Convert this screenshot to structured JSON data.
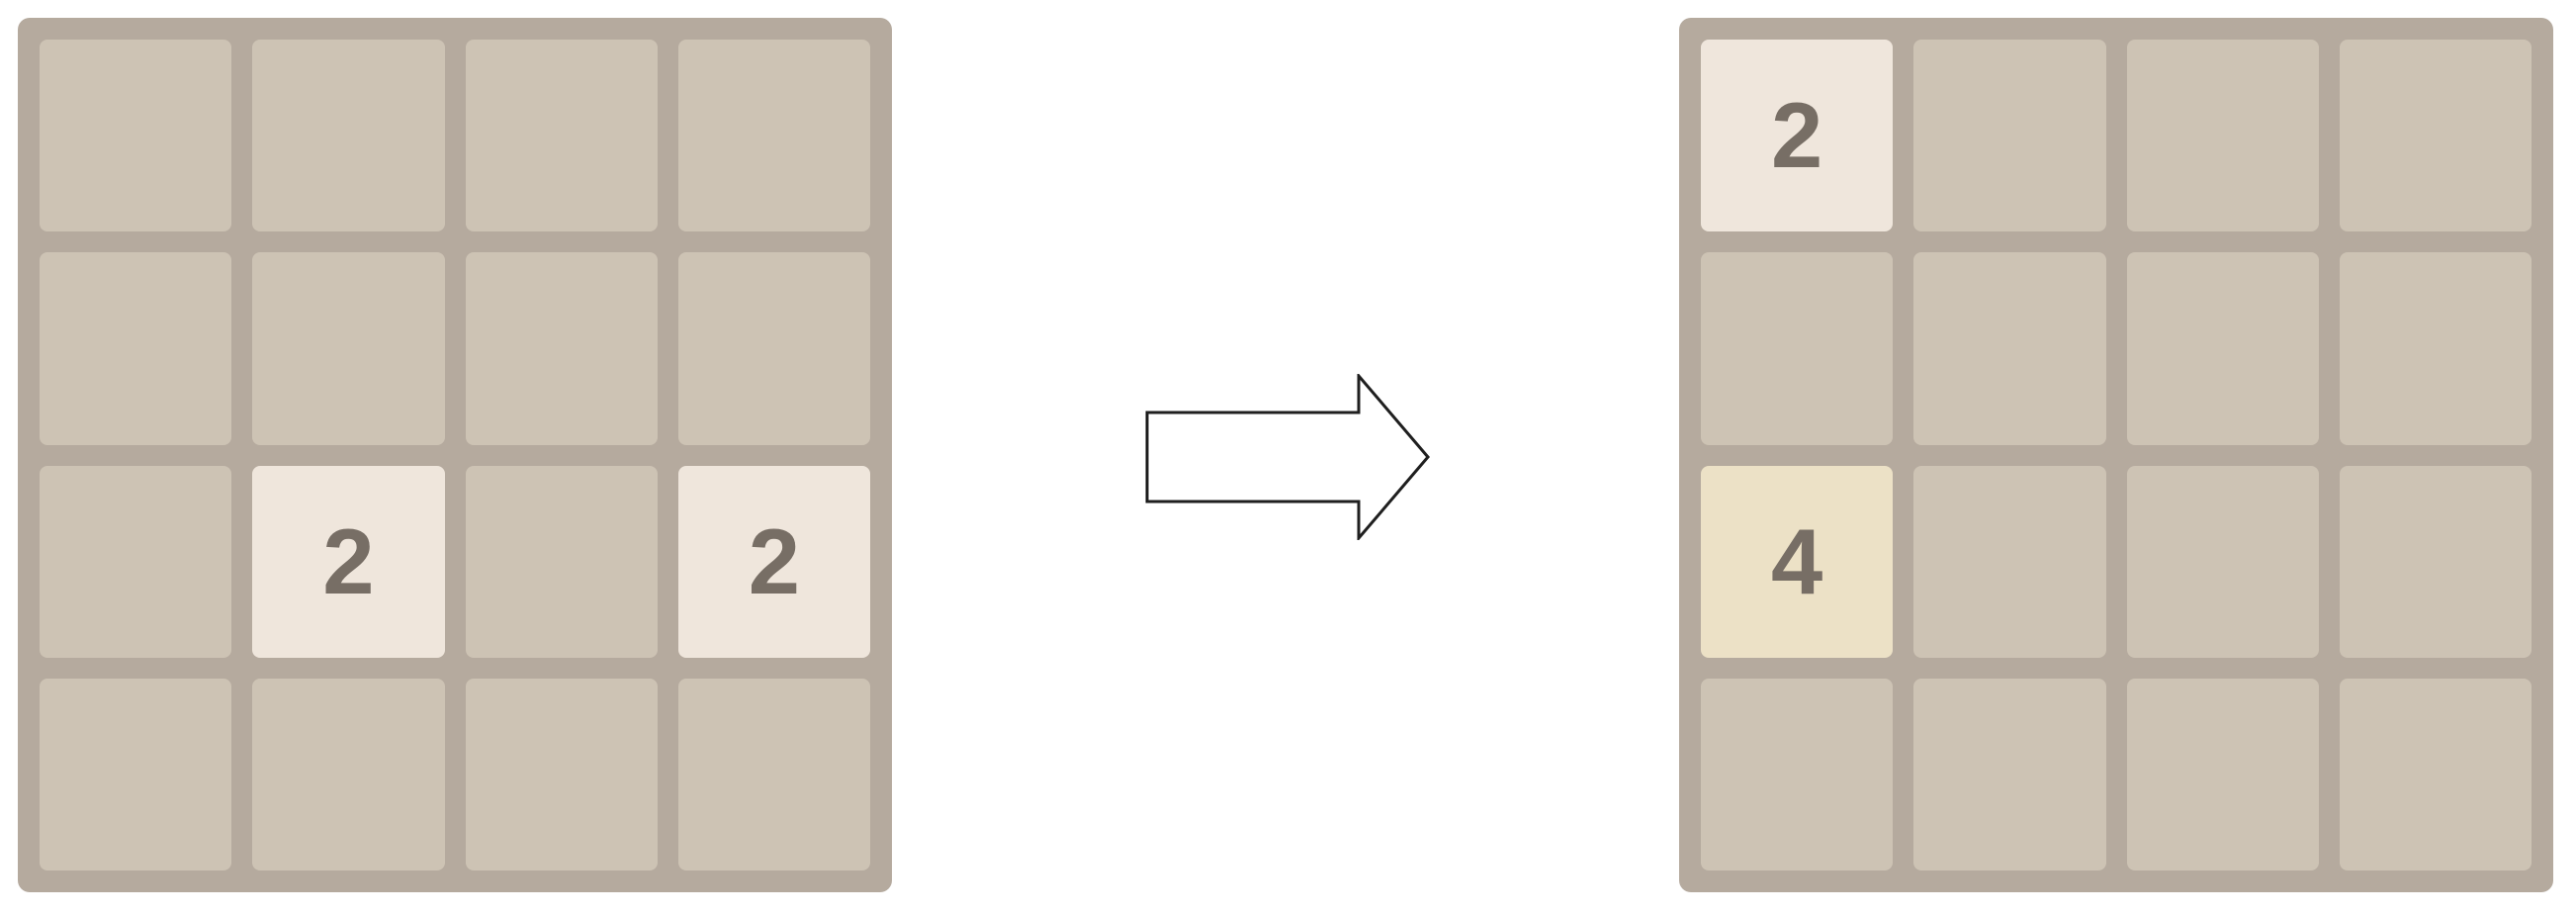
{
  "page": {
    "background": "#ffffff"
  },
  "colors": {
    "board_bg": "#b5aa9e",
    "empty_cell": "#cdc3b4",
    "tile_2_bg": "#efe6dc",
    "tile_4_bg": "#ece1c6",
    "tile_text": "#776e65",
    "arrow_fill": "#ffffff",
    "arrow_stroke": "#1f1f1f"
  },
  "boards": [
    {
      "id": "before",
      "rows": 4,
      "cols": 4,
      "tiles": [
        {
          "row": 2,
          "col": 1,
          "value": "2"
        },
        {
          "row": 2,
          "col": 3,
          "value": "2"
        }
      ]
    },
    {
      "id": "after",
      "rows": 4,
      "cols": 4,
      "tiles": [
        {
          "row": 0,
          "col": 0,
          "value": "2"
        },
        {
          "row": 2,
          "col": 0,
          "value": "4"
        }
      ]
    }
  ],
  "arrow": {
    "direction": "right"
  }
}
